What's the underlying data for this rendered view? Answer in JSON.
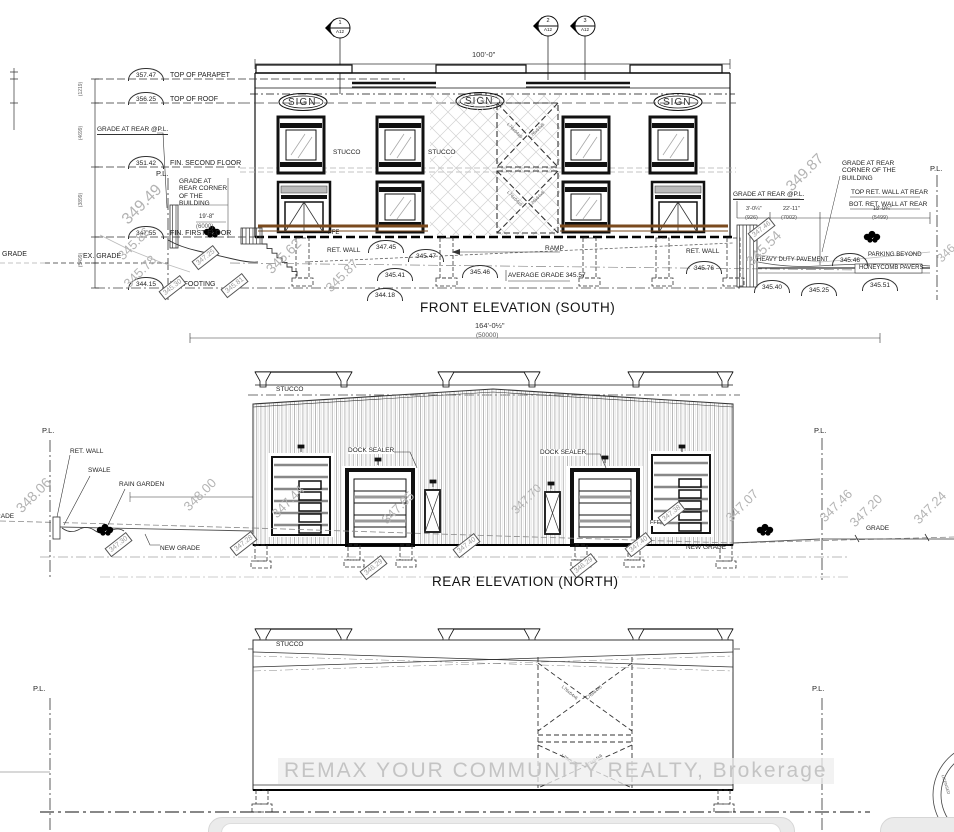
{
  "watermark": {
    "text": "REMAX YOUR COMMUNITY REALTY, Brokerage"
  },
  "stamp": {
    "text": "LICENSED"
  },
  "markers": [
    {
      "num": "1",
      "sheet": "A12"
    },
    {
      "num": "2",
      "sheet": "A12"
    },
    {
      "num": "3",
      "sheet": "A12"
    }
  ],
  "front": {
    "title": "FRONT ELEVATION (SOUTH)",
    "dim_top": "100'-0\"",
    "dim_bottom_ft": "164'-0½\"",
    "dim_bottom_mm": "(50000)",
    "sign1": "SIGN",
    "sign2": "SIGN",
    "sign3": "SIGN",
    "stucco_left": "STUCCO",
    "stucco_right": "STUCCO",
    "ffe": "FFE",
    "ramp": "RAMP",
    "ret_wall_left": "RET. WALL",
    "ret_wall_right": "RET. WALL",
    "average_grade": "AVERAGE GRADE 345.57",
    "ex_grade": "EX. GRADE",
    "grade_left": "GRADE",
    "pl_left": "P.L.",
    "pl_right": "P.L.",
    "grade_at_rear_pl_left": "GRADE AT REAR @P.L.",
    "grade_at_rear_pl_right": "GRADE AT REAR @P.L.",
    "grade_rear_corner_left": "GRADE AT REAR CORNER OF THE BUILDING",
    "grade_rear_corner_right": "GRADE AT REAR CORNER OF THE BUILDING",
    "top_ret_wall": "TOP RET. WALL AT REAR",
    "bot_ret_wall": "BOT. RET. WALL AT REAR",
    "heavy_duty": "HEAVY DUTY PAVEMENT",
    "parking_beyond": "PARKING BEYOND",
    "honeycomb": "HONEYCOMB PAVERS",
    "dim_6000_ft": "19'-8\"",
    "dim_6000_mm": "(6000)",
    "dim_926_ft": "3'-0¼\"",
    "dim_926_mm": "(926)",
    "dim_7002_ft": "22'-11\"",
    "dim_7002_mm": "(7002)",
    "dim_5499_ft": "18'-0¾\"",
    "dim_5499_mm": "(5499)",
    "brace_label": "L76x64x6",
    "levels": [
      {
        "value": "357.47",
        "label": "TOP OF PARAPET"
      },
      {
        "value": "356.25",
        "label": "TOP OF ROOF"
      },
      {
        "value": "351.42",
        "label": "FIN. SECOND FLOOR"
      },
      {
        "value": "347.55",
        "label": "FIN. FIRST FLOOR"
      },
      {
        "value": "344.15",
        "label": "U/S FOOTING"
      }
    ],
    "vdims": [
      "(1219)",
      "(4699)",
      "(3899)",
      "(5499)"
    ],
    "arcs": [
      "347.45",
      "345.47",
      "345.41",
      "344.18",
      "345.46",
      "345.76",
      "345.46",
      "345.40",
      "345.25",
      "345.51"
    ],
    "spots": [
      "349.49",
      "345.86",
      "345.78",
      "345.62",
      "345.87",
      "349.87",
      "345.54",
      "346"
    ],
    "tags": [
      "347.25",
      "345.30",
      "345.81",
      "347.46"
    ]
  },
  "rear": {
    "title": "REAR ELEVATION (NORTH)",
    "stucco": "STUCCO",
    "dock_sealer_left": "DOCK SEALER",
    "dock_sealer_right": "DOCK SEALER",
    "pl_left": "P.L.",
    "pl_right": "P.L.",
    "ret_wall": "RET. WALL",
    "swale": "SWALE",
    "rain_garden": "RAIN GARDEN",
    "new_grade_left": "NEW GRADE",
    "new_grade_right": "NEW GRADE",
    "grade_left": "GRADE",
    "grade_right": "GRADE",
    "ffe": "FFE",
    "spots": [
      "348.06",
      "348.00",
      "347.44",
      "347.65",
      "347.70",
      "347.07",
      "347.46",
      "347.20",
      "347.24"
    ],
    "tags": [
      "347.30",
      "347.28",
      "346.29",
      "347.40",
      "346.29",
      "347.40",
      "347.38"
    ]
  },
  "third": {
    "stucco": "STUCCO",
    "pl_left": "P.L.",
    "pl_right": "P.L.",
    "brace_label": "L76x64x6"
  }
}
